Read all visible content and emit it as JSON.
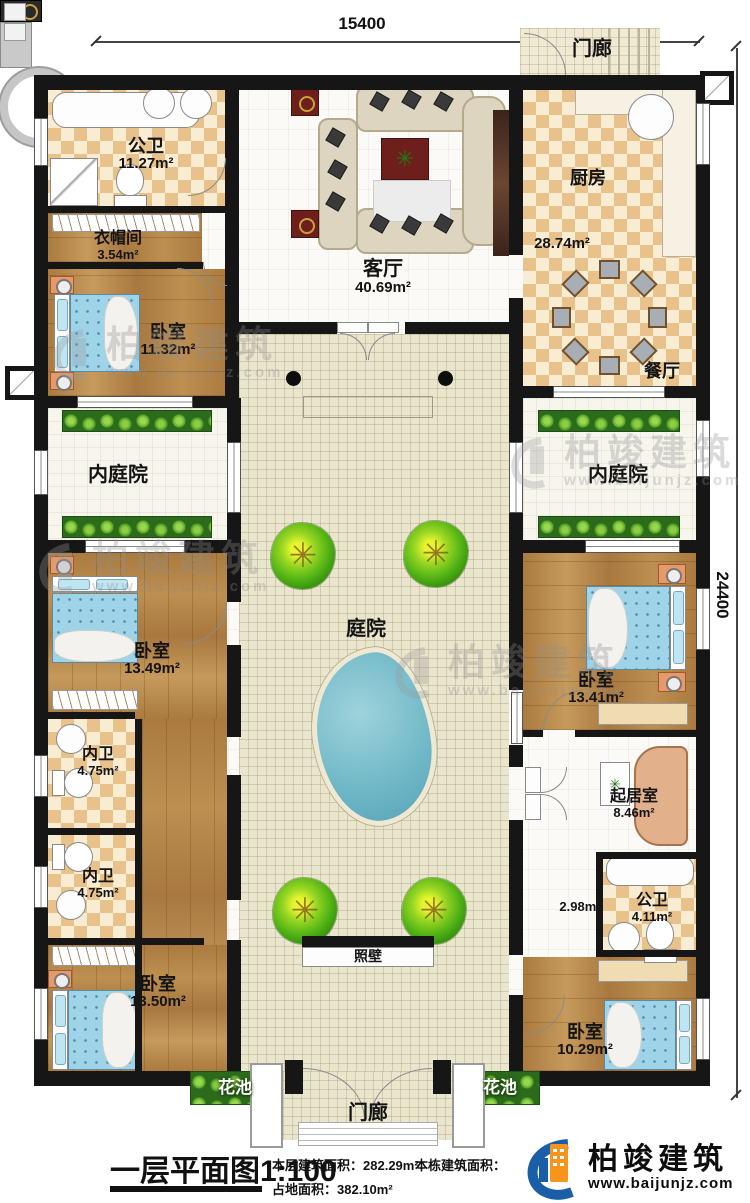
{
  "dimensions": {
    "top": "15400",
    "right": "24400"
  },
  "rooms": {
    "porch_top": {
      "name": "门廊"
    },
    "public_bath_top": {
      "name": "公卫",
      "area": "11.27m²"
    },
    "cloakroom": {
      "name": "衣帽间",
      "area": "3.54m²"
    },
    "bedroom_top_left": {
      "name": "卧室",
      "area": "11.32m²"
    },
    "living_room": {
      "name": "客厅",
      "area": "40.69m²"
    },
    "kitchen": {
      "name": "厨房",
      "area": "28.74m²"
    },
    "dining_room": {
      "name": "餐厅"
    },
    "inner_courtyard_left": {
      "name": "内庭院"
    },
    "inner_courtyard_right": {
      "name": "内庭院"
    },
    "courtyard": {
      "name": "庭院"
    },
    "bedroom_mid_left": {
      "name": "卧室",
      "area": "13.49m²"
    },
    "inner_bath_1": {
      "name": "内卫",
      "area": "4.75m²"
    },
    "inner_bath_2": {
      "name": "内卫",
      "area": "4.75m²"
    },
    "bedroom_bottom_left": {
      "name": "卧室",
      "area": "13.50m²"
    },
    "bedroom_mid_right": {
      "name": "卧室",
      "area": "13.41m²"
    },
    "sitting_room": {
      "name": "起居室",
      "area": "8.46m²"
    },
    "hallway": {
      "area": "2.98m²"
    },
    "public_bath_bottom": {
      "name": "公卫",
      "area": "4.11m²"
    },
    "bedroom_bottom_right": {
      "name": "卧室",
      "area": "10.29m²"
    },
    "screen_wall": {
      "name": "照壁"
    },
    "flower_bed_left": {
      "name": "花池"
    },
    "flower_bed_right": {
      "name": "花池"
    },
    "porch_bottom": {
      "name": "门廊"
    }
  },
  "footer": {
    "title": "一层平面图",
    "scale": "1:100",
    "floor_area_label": "本层建筑面积：",
    "floor_area_value": "282.29m²",
    "land_area_label": "占地面积：",
    "land_area_value": "382.10m²",
    "building_area_label": "本栋建筑面积：",
    "logo_brand": "柏竣建筑",
    "logo_site": "www.baijunjz.com"
  },
  "watermark": {
    "brand": "柏竣建筑",
    "site": "www.baijunjz.com"
  },
  "colors": {
    "wall": "#161616",
    "checker_dark": "#e9c28b",
    "checker_light": "#f8ecd2",
    "wood": "#b28148",
    "courtyard_tile": "#eae5cd",
    "plant_green": "#2c6b1c",
    "pond_blue": "#6fb7c7",
    "logo_blue": "#1b5ea8",
    "logo_orange": "#f7941d"
  }
}
